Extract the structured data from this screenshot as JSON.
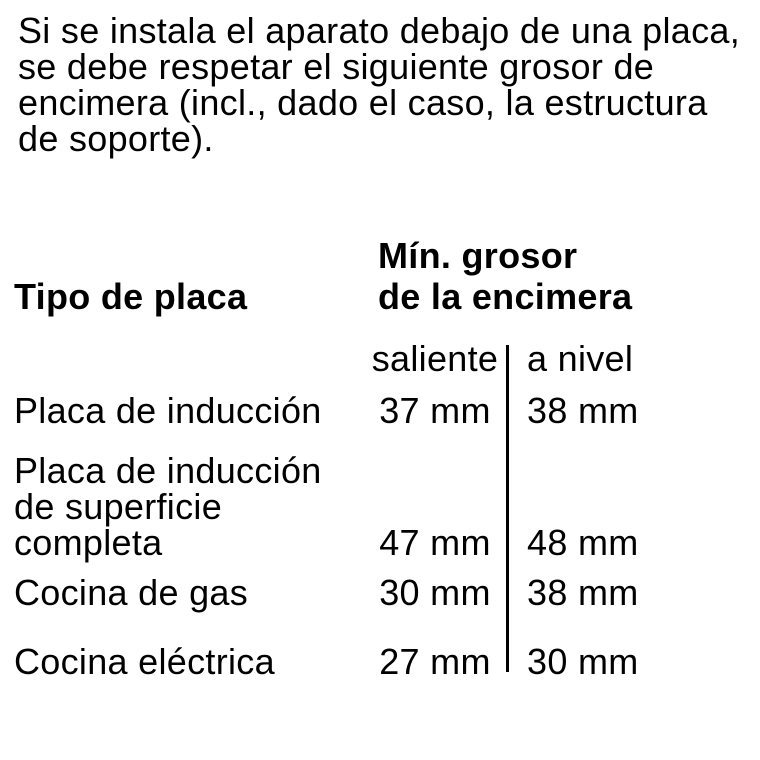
{
  "page": {
    "background_color": "#ffffff",
    "text_color": "#000000",
    "divider_color": "#000000"
  },
  "intro": {
    "lines": [
      "Si se instala el aparato debajo de una placa,",
      "se debe respetar el siguiente grosor de",
      "encimera (incl., dado el caso, la estructura",
      "de soporte)."
    ]
  },
  "table": {
    "col1_header": "Tipo de placa",
    "col2_header_lines": [
      "Mín. grosor",
      "de la encimera"
    ],
    "subcolumns": [
      "saliente",
      "a nivel"
    ],
    "unit": "mm",
    "rows": [
      {
        "label_lines": [
          "Placa de inducción"
        ],
        "saliente": "37 mm",
        "a_nivel": "38 mm"
      },
      {
        "label_lines": [
          "Placa de inducción",
          "de superficie",
          "completa"
        ],
        "saliente": "47 mm",
        "a_nivel": "48 mm"
      },
      {
        "label_lines": [
          "Cocina de gas"
        ],
        "saliente": "30 mm",
        "a_nivel": "38 mm"
      },
      {
        "label_lines": [
          "Cocina eléctrica"
        ],
        "saliente": "27 mm",
        "a_nivel": "30 mm"
      }
    ]
  }
}
